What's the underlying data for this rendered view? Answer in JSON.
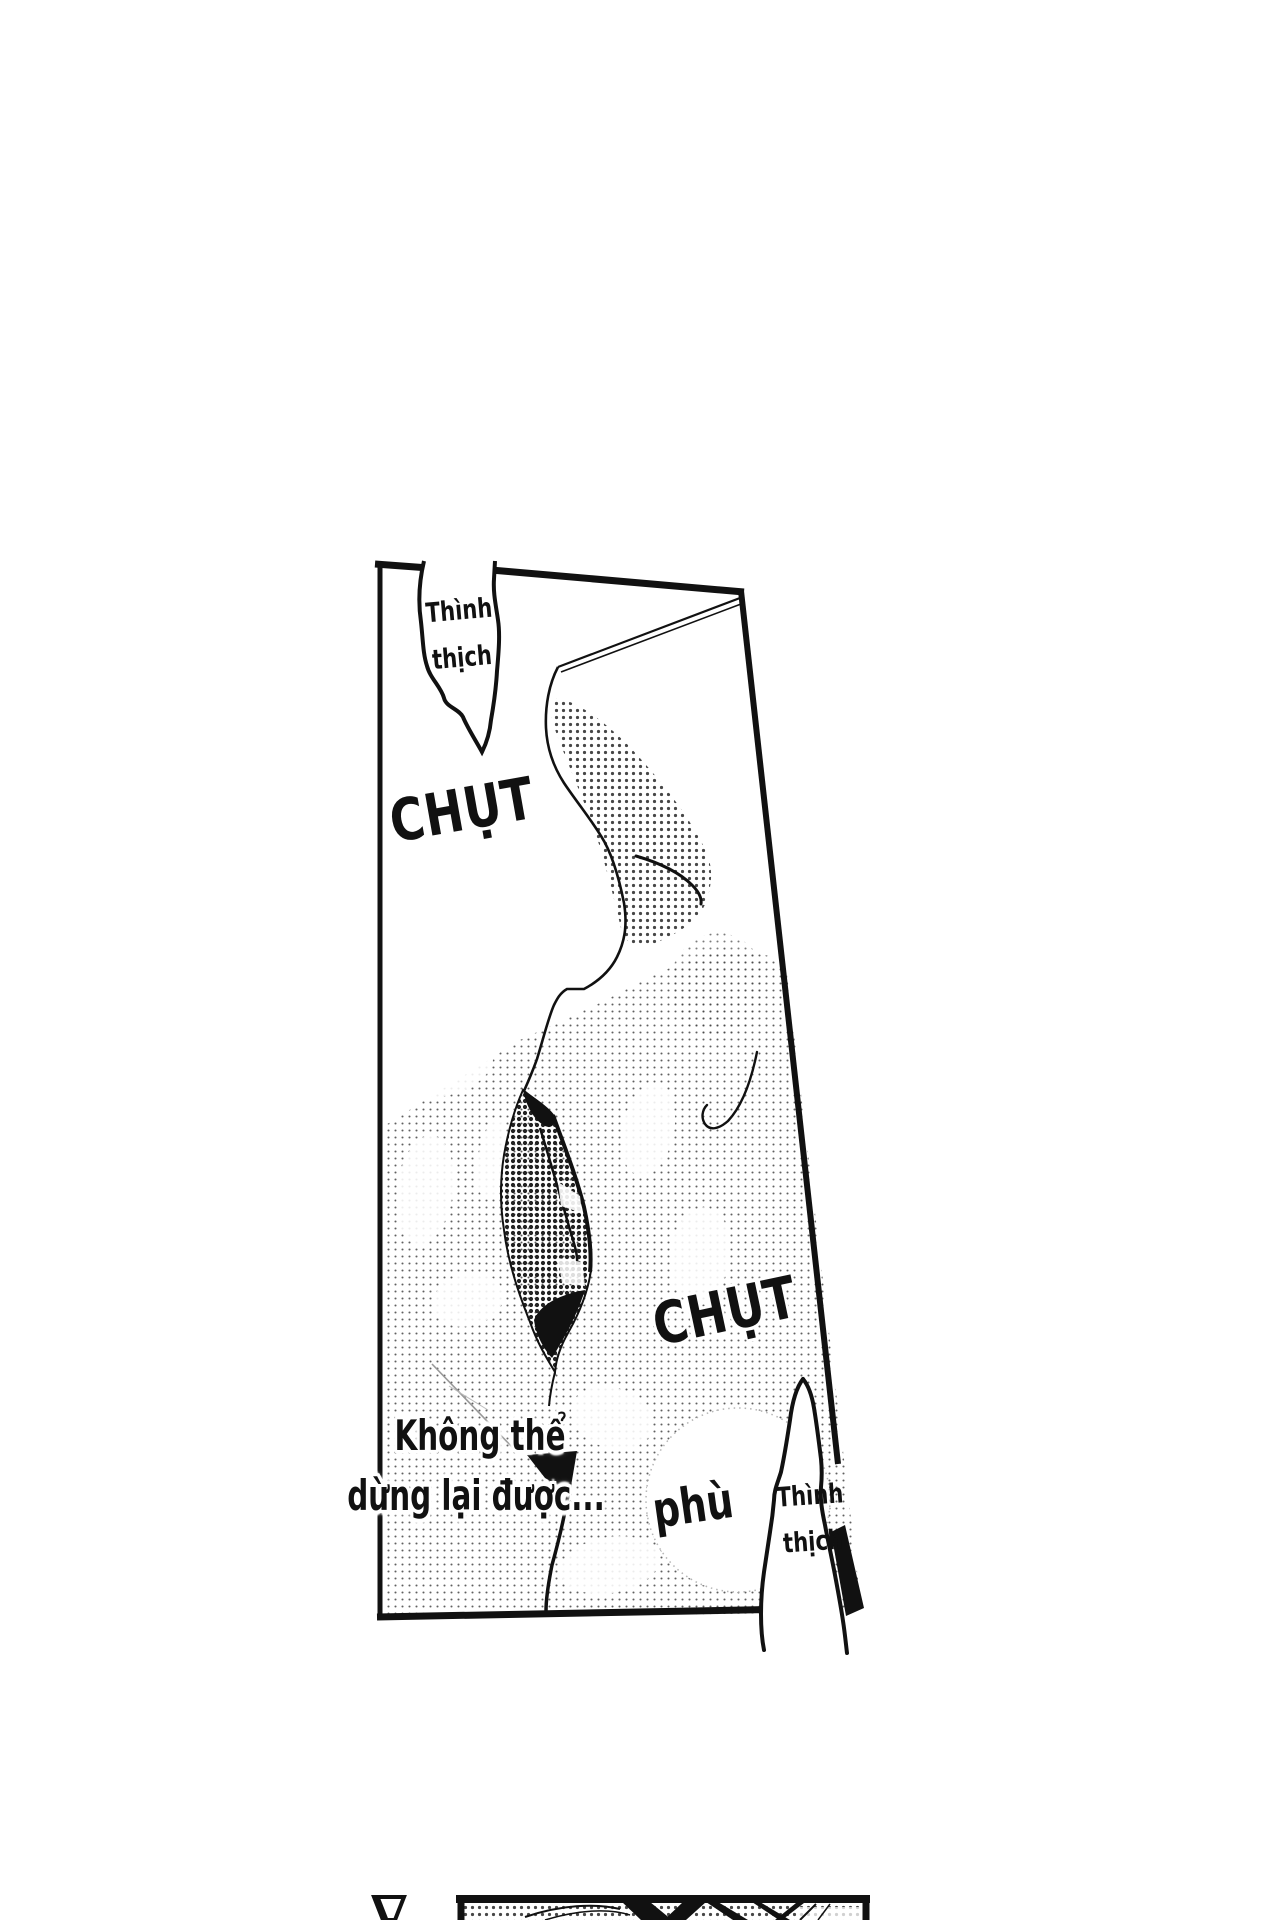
{
  "colors": {
    "paper": "#ffffff",
    "ink": "#111111"
  },
  "main_panel": {
    "bubble_top": {
      "line1": "Thình",
      "line2": "thịch"
    },
    "sfx_kiss_top": "CHỤT",
    "sfx_kiss_bottom": "CHỤT",
    "sfx_breath": "phù",
    "bubble_bottom": {
      "line1": "Thình",
      "line2": "thịch"
    },
    "narration": {
      "line1": "Không thể",
      "line2": "dừng lại được..."
    }
  }
}
